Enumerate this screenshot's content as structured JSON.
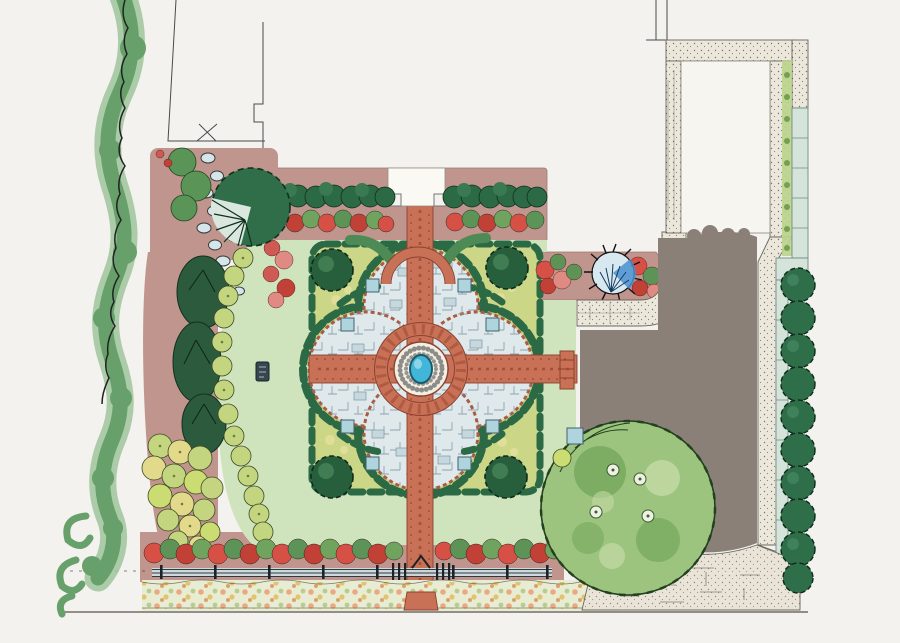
{
  "figure": {
    "label": "Hand-rendered watercolor landscape master plan of a formal walled garden",
    "type": "landscape-plan-illustration",
    "features": [
      "vine-border",
      "property-line",
      "neighbor-building-outline",
      "upper-terrace",
      "entry-steps",
      "entry-pedestals",
      "clipped-hedge-row",
      "rose-border",
      "stepping-stone-path",
      "fan-palm-tree",
      "conifer-screen",
      "shrub-border",
      "great-lawn",
      "formal-parterre",
      "quatrefoil-paving",
      "brick-cross-walk",
      "central-fountain-pool",
      "gravel-ring",
      "corner-topiary",
      "garden-bench",
      "trellis-arch",
      "perennial-bed-east",
      "blue-agave",
      "stone-walk",
      "walled-court",
      "boundary-wall",
      "espalier-strip",
      "columnar-hedge-row",
      "gravel-driveway",
      "stone-apron",
      "specimen-shade-tree",
      "rose-hedge",
      "post-and-rail-fence",
      "garden-gate",
      "wildflower-meadow-strip",
      "street-baseline",
      "artist-seal"
    ]
  },
  "palette": {
    "paper": "#f3f2ee",
    "paper_bright": "#faf9f4",
    "lawn": "#cfe3bd",
    "mauve": "#c0958d",
    "mauve_dark": "#ad7f77",
    "brick": "#c97156",
    "brick_dark": "#8a4330",
    "hedge_dark": "#2c6a45",
    "topiary": "#275f3d",
    "olive_bed": "#cbd687",
    "chartreuse": "#c3d57f",
    "paving": "#dfe9ec",
    "paving_stone": "#c6d8de",
    "pool": "#41b6d8",
    "gravel": "#f2efe4",
    "stone": "#ece7db",
    "stone_white": "#f6f5ef",
    "wall_panel": "#d5e4da",
    "gray_drive": "#8a8078",
    "apron": "#e9e4d7",
    "tree": "#9cc47e",
    "tree_dark": "#74a85c",
    "tree_pale": "#c6dba6",
    "meadow": "#e7ecd2",
    "rose": "#d65045",
    "rose_deep": "#c24136",
    "rose_leaf": "#5d9357",
    "vine": "#67a06a",
    "vine_light": "#9fc69c",
    "conifer": "#2b5a3d",
    "bench": "#aed4de",
    "agave_blue": "#4a90d0",
    "agave_pale": "#d7e8f0",
    "cypress": "#2e6e49",
    "ink": "#222222",
    "line": "#4a4a4a"
  }
}
